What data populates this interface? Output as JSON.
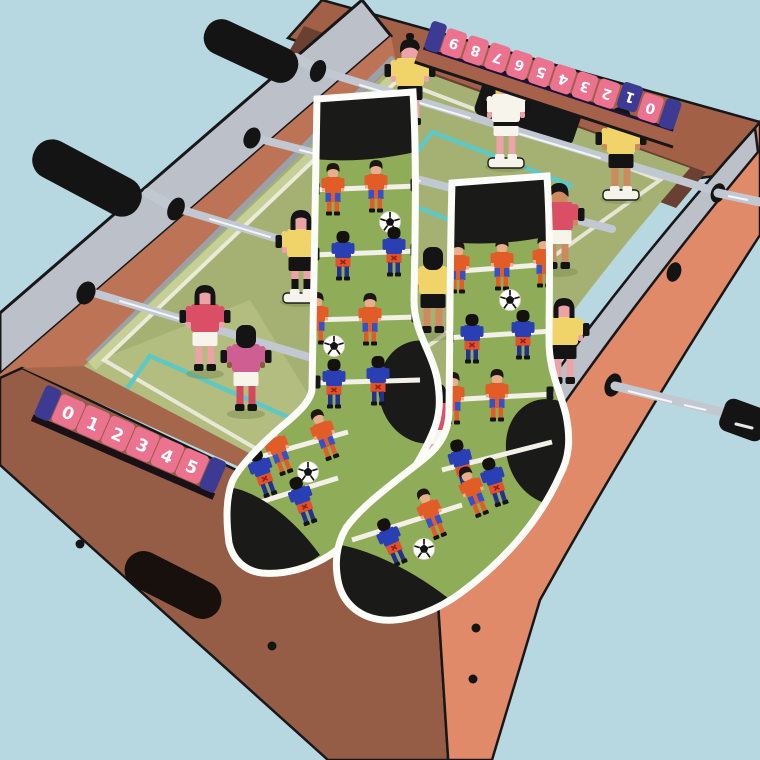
{
  "counters": {
    "far": {
      "digits": [
        "9",
        "8",
        "7",
        "6",
        "5",
        "4",
        "3",
        "2",
        "1",
        "0"
      ],
      "flipped_bead_digit": "1",
      "orientation": "upside-down"
    },
    "near": {
      "digits": [
        "0",
        "1",
        "2",
        "3",
        "4",
        "5"
      ]
    }
  },
  "colors": {
    "sky": "#b7d8e0",
    "rim_metal": "#bcc1c9",
    "rim_wood": "#bd7355",
    "far_wall_wood": "#a26046",
    "inner_wall_dark": "#6a4033",
    "front_face_wood": "#955d46",
    "side_face_salmon": "#e18a69",
    "field_green": "#a5b173",
    "field_light": "#c6cf96",
    "line_teal": "#5ec8c4",
    "line_white": "#f2efe4",
    "counter_pink": "#ec7390",
    "counter_navy": "#3c3a93",
    "rod_silver": "#c2c8d2",
    "handle_black": "#141414",
    "goal_black": "#171717",
    "sock_green": "#8fac58",
    "sock_black": "#1a1a18",
    "sock_outline": "#fcfcf9",
    "kit_orange": "#e25c28",
    "kit_blue": "#2b3fb5",
    "jersey_yellow": "#f1d469",
    "jersey_white": "#f7f4ec",
    "jersey_crimson": "#da4f66",
    "jersey_magenta": "#cf5f92",
    "skin_pink": "#eca3a8",
    "skin_tan": "#cd8a5f",
    "skin_brown": "#8a5a3c"
  }
}
